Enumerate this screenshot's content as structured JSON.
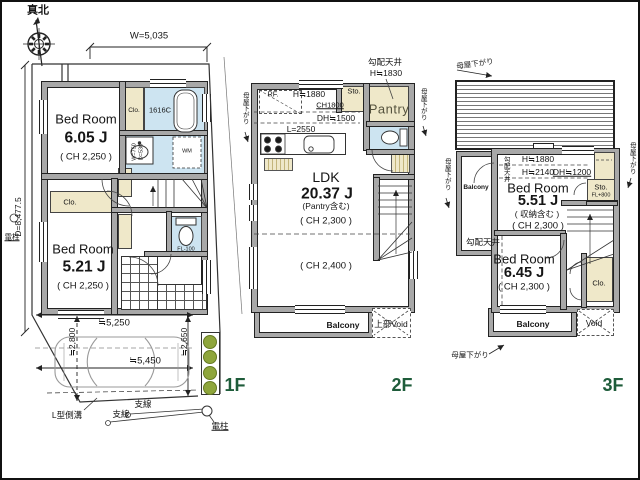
{
  "compass": {
    "label": "真北"
  },
  "colors": {
    "floor_label_green": "#1e5c3a",
    "closet_beige": "#efe8c9",
    "wet_area_blue": "#cde4f1",
    "wall_gray": "#a8a8a8",
    "bush_green": "#8fa63c"
  },
  "f1": {
    "floor_label": "1F",
    "dim_width": "W=5,035",
    "dim_depth": "D=8,477.5",
    "pole_left": "電柱",
    "bedroom1": {
      "name": "Bed Room",
      "area": "6.05 J",
      "ch": "( CH 2,250 )"
    },
    "closet1": "Clo.",
    "bath_unit": "1616C",
    "wash_w": "W=750",
    "wash_d": "D=530",
    "washer": "WM",
    "closet2": "Clo.",
    "bedroom2": {
      "name": "Bed Room",
      "area": "5.21 J",
      "ch": "( CH 2,250 )"
    },
    "toilet_fl": "FL-100",
    "dim_park_width": "≒5,250",
    "dim_car_length": "≒5,450",
    "dim_park_left": "≒2,800",
    "dim_park_right": "≒2,650",
    "gutter": "L型側溝",
    "wire_a": "支線",
    "wire_b": "支線",
    "pole_bottom": "電柱"
  },
  "f2": {
    "floor_label": "2F",
    "sloped_title": "勾配天井",
    "sloped_h": "H≒1830",
    "moya_left": "母屋下がり",
    "moya_right": "母屋下がり",
    "fridge": "RF.",
    "h1880": "H≒1880",
    "ch1800": "CH1800",
    "dh1500": "DH≒1500",
    "storage": "Sto.",
    "pantry": "Pantry",
    "counter_length": "L=2550",
    "ldk": {
      "name": "LDK",
      "area": "20.37 J",
      "note": "(Pantry含む)",
      "ch_upper": "( CH 2,300 )",
      "ch_lower": "( CH 2,400 )"
    },
    "balcony": "Balcony",
    "upper_void": "上部Void"
  },
  "f3": {
    "floor_label": "3F",
    "moya_top": "母屋下がり",
    "moya_left": "母屋下がり",
    "moya_right": "母屋下がり",
    "moya_bottom": "母屋下がり",
    "h1880": "H≒1880",
    "h2140": "H≒2140",
    "dh1200": "DH≒1200",
    "sloped_side": "勾配天井",
    "sloped_room": "勾配天井",
    "bedroom1": {
      "name": "Bed Room",
      "area": "5.51 J",
      "note": "( 収納含む )",
      "ch": "( CH 2,300 )"
    },
    "storage": "Sto.",
    "storage_fl": "FL+800",
    "balcony_left": "Balcony",
    "bedroom2": {
      "name": "Bed Room",
      "area": "6.45 J",
      "ch": "( CH 2,300 )"
    },
    "closet": "Clo.",
    "balcony_bottom": "Balcony",
    "void": "Void"
  }
}
